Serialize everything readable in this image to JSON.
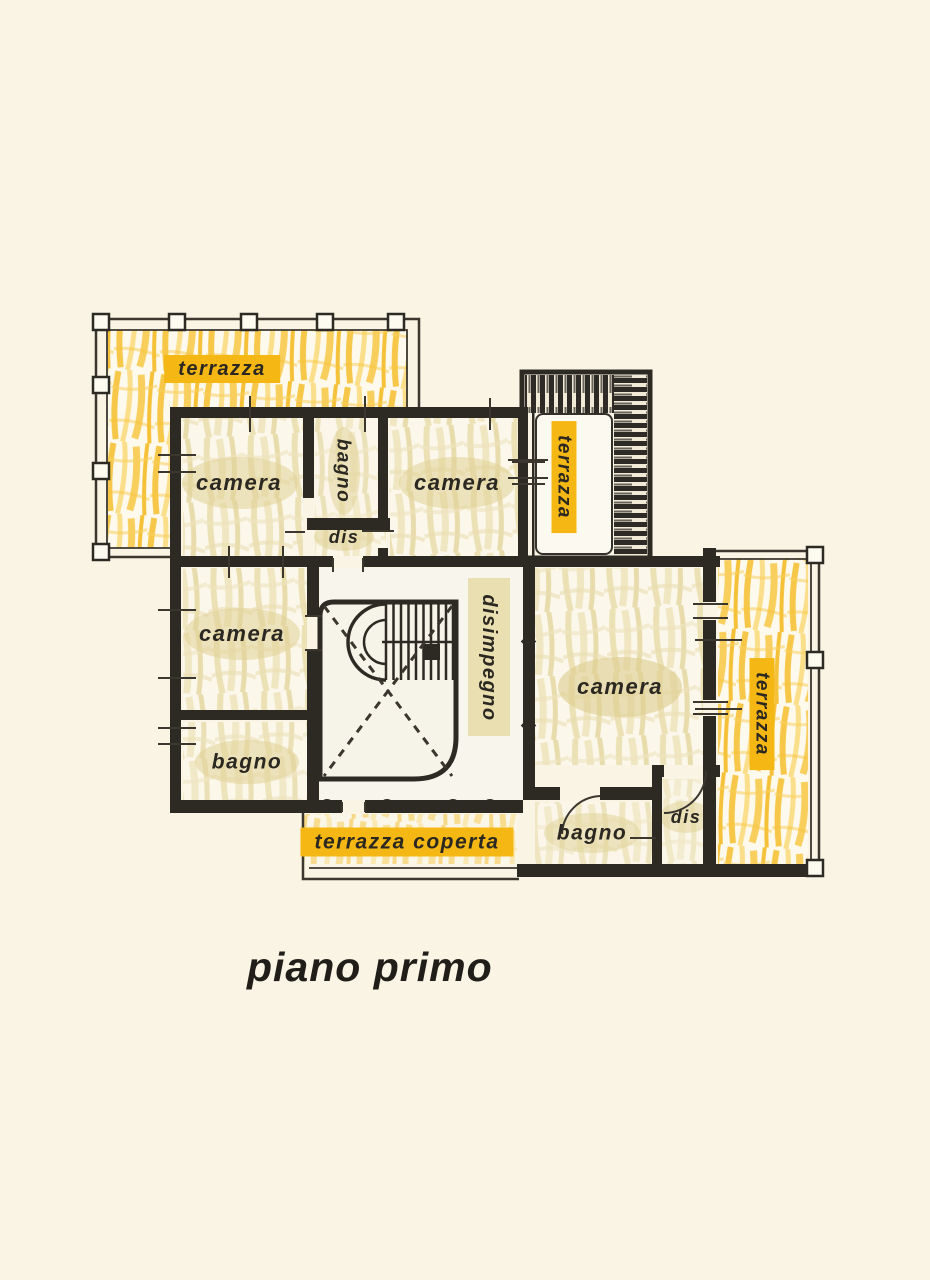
{
  "title": {
    "text": "piano primo"
  },
  "rooms": {
    "terrazza_top_left": "terrazza",
    "camera_nw": "camera",
    "bagno_top": "bagno",
    "dis_top": "dis",
    "camera_ne": "camera",
    "terrazza_top_right": "terrazza",
    "camera_w": "camera",
    "disimpegno": "disimpegno",
    "camera_e": "camera",
    "terrazza_right": "terrazza",
    "bagno_w": "bagno",
    "terrazza_coperta": "terrazza coperta",
    "bagno_s": "bagno",
    "dis_s": "dis"
  },
  "colors": {
    "background": "#f9f4e4",
    "wall": "#2d2a24",
    "highlight_amber": "#f4b713",
    "scribble_yellow": "#f6c33a",
    "scribble_beige": "#e9dcae",
    "label_text": "#2b2822"
  }
}
